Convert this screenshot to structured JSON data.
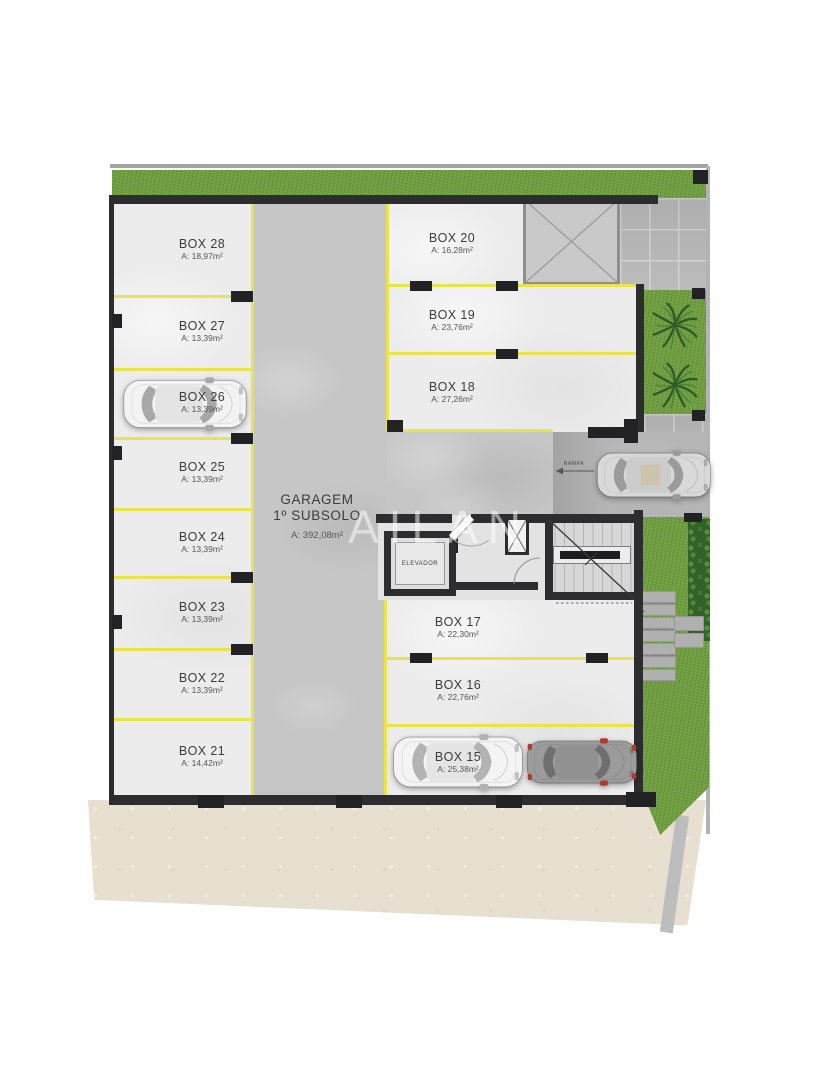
{
  "watermark": "AILAN",
  "garage": {
    "title": "GARAGEM",
    "subtitle": "1º SUBSOLO",
    "area": "A: 392,08m²"
  },
  "elevator": {
    "label": "ELEVADOR"
  },
  "ramp": {
    "label": "RAMPA"
  },
  "boxes": [
    {
      "name": "BOX 28",
      "area": "A: 18,97m²"
    },
    {
      "name": "BOX 27",
      "area": "A: 13,39m²"
    },
    {
      "name": "BOX 26",
      "area": "A: 13,39m²"
    },
    {
      "name": "BOX 25",
      "area": "A: 13,39m²"
    },
    {
      "name": "BOX 24",
      "area": "A: 13,39m²"
    },
    {
      "name": "BOX 23",
      "area": "A: 13,39m²"
    },
    {
      "name": "BOX 22",
      "area": "A: 13,39m²"
    },
    {
      "name": "BOX 21",
      "area": "A: 14,42m²"
    },
    {
      "name": "BOX 20",
      "area": "A: 16,28m²"
    },
    {
      "name": "BOX 19",
      "area": "A: 23,76m²"
    },
    {
      "name": "BOX 18",
      "area": "A: 27,26m²"
    },
    {
      "name": "BOX 17",
      "area": "A: 22,30m²"
    },
    {
      "name": "BOX 16",
      "area": "A: 22,76m²"
    },
    {
      "name": "BOX 15",
      "area": "A: 25,38m²"
    }
  ],
  "colors": {
    "wall": "#2d2d2f",
    "parking_line": "#e9e44c",
    "grass": "#6f9e3f",
    "hedge": "#33612a",
    "sand": "#e7e0d1",
    "aisle_concrete": "#c6c6c6",
    "box_floor": "#ececec"
  }
}
